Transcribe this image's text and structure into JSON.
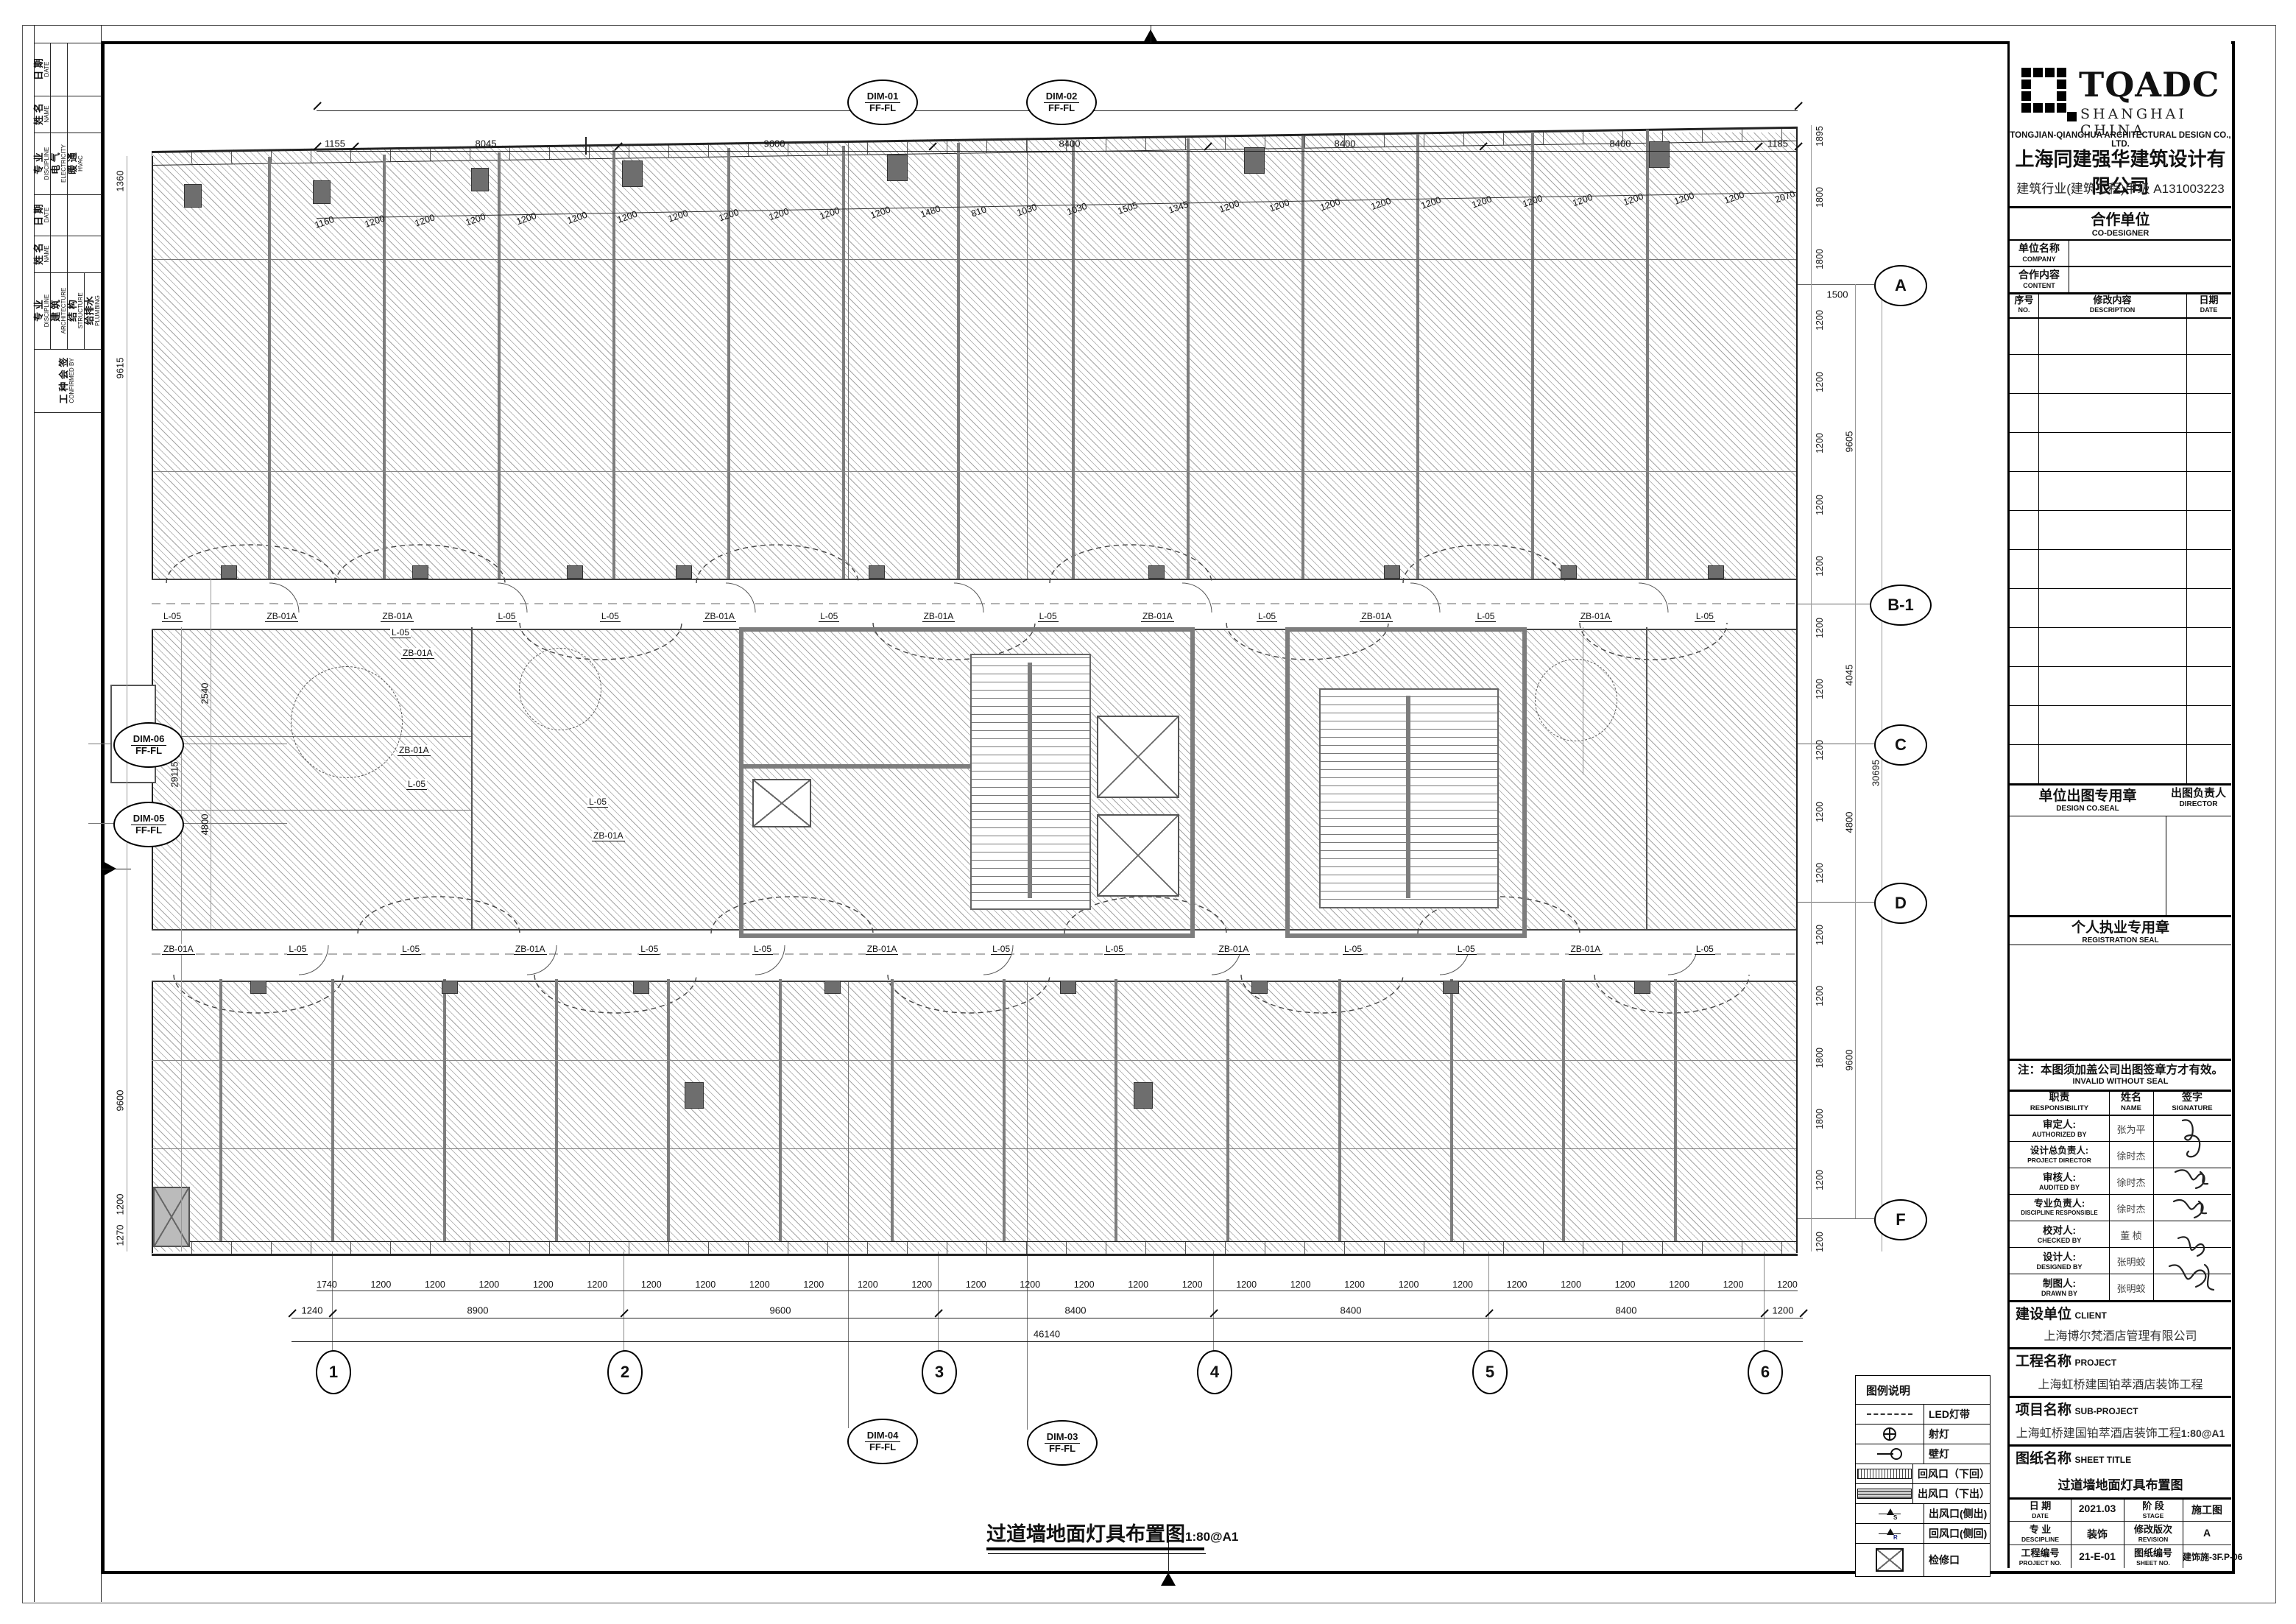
{
  "drawing": {
    "title": "过道墙地面灯具布置图",
    "scale": "1:80@A1"
  },
  "strip": {
    "date_cn": "日 期",
    "date_en": "DATE",
    "name_cn": "姓 名",
    "name_en": "NAME",
    "disc_cn": "专 业",
    "disc_en": "DISCIPLINE",
    "elec_cn": "电 气",
    "elec_en": "ELECTRICITY",
    "hvac_cn": "暖 通",
    "hvac_en": "HVAC",
    "arch_cn": "建 筑",
    "arch_en": "ARCHITECTURE",
    "struct_cn": "结 构",
    "struct_en": "STRUCTURE",
    "plumb_cn": "给排水",
    "plumb_en": "PLUMBING",
    "title_cn": "工 种 会 签",
    "title_en": "CONFIRMED BY"
  },
  "plan": {
    "grid_cols": [
      "1",
      "2",
      "3",
      "4",
      "5",
      "6"
    ],
    "grid_rows": [
      "A",
      "B-1",
      "C",
      "D",
      "F"
    ],
    "callouts": {
      "c1": {
        "id": "DIM-01",
        "tag": "FF-FL"
      },
      "c2": {
        "id": "DIM-02",
        "tag": "FF-FL"
      },
      "c3": {
        "id": "DIM-03",
        "tag": "FF-FL"
      },
      "c4": {
        "id": "DIM-04",
        "tag": "FF-FL"
      },
      "c5": {
        "id": "DIM-05",
        "tag": "FF-FL"
      },
      "c6": {
        "id": "DIM-06",
        "tag": "FF-FL"
      }
    },
    "dims": {
      "top_overall": "45200",
      "top_segments": [
        "1155",
        "8045",
        "9600",
        "8400",
        "8400",
        "8400",
        "1185"
      ],
      "top_detail": [
        "1160",
        "1200",
        "1200",
        "1200",
        "1200",
        "1200",
        "1200",
        "1200",
        "1200",
        "1200",
        "1200",
        "1200",
        "1480",
        "810",
        "1030",
        "1030",
        "1505",
        "1345",
        "1200",
        "1200",
        "1200",
        "1200",
        "1200",
        "1200",
        "1200",
        "1200",
        "1200",
        "1200",
        "1200",
        "2070"
      ],
      "bottom_detail": [
        "1740",
        "1200",
        "1200",
        "1200",
        "1200",
        "1200",
        "1200",
        "1200",
        "1200",
        "1200",
        "1200",
        "1200",
        "1200",
        "1200",
        "1200",
        "1200",
        "1200",
        "1200",
        "1200",
        "1200",
        "1200",
        "1200",
        "1200",
        "1200",
        "1200",
        "1200",
        "1200",
        "1200"
      ],
      "bottom_segments": [
        "1240",
        "8900",
        "9600",
        "8400",
        "8400",
        "8400",
        "1200"
      ],
      "bottom_overall": "46140",
      "left": [
        "1360",
        "9615",
        "2540",
        "29115",
        "4800",
        "9600",
        "1200",
        "1270"
      ],
      "right_ticks": [
        "1895",
        "1800",
        "1800",
        "1200",
        "1200",
        "1200",
        "1200",
        "1200",
        "1200",
        "1200",
        "1200",
        "1200",
        "1200",
        "1200",
        "1200",
        "1800",
        "1800",
        "1200",
        "1200"
      ],
      "right_segments": [
        "9605",
        "4045",
        "4800",
        "9600"
      ],
      "right_overall": "30695",
      "right_small": "1500"
    },
    "corridor_labels_upper": [
      "L-05",
      "ZB-01A",
      "ZB-01A",
      "L-05",
      "L-05",
      "ZB-01A",
      "L-05",
      "ZB-01A",
      "L-05",
      "ZB-01A",
      "L-05",
      "ZB-01A",
      "L-05",
      "ZB-01A",
      "L-05"
    ],
    "corridor_labels_lower": [
      "ZB-01A",
      "L-05",
      "L-05",
      "ZB-01A",
      "L-05",
      "L-05",
      "ZB-01A",
      "L-05",
      "L-05",
      "ZB-01A",
      "L-05",
      "L-05",
      "ZB-01A",
      "L-05"
    ],
    "mid_labels": [
      "L-05",
      "ZB-01A",
      "ZB-01A",
      "L-05",
      "L-05",
      "ZB-01A"
    ]
  },
  "legend": {
    "title": "图例说明",
    "rows": [
      {
        "symbol": "led-strip",
        "label": "LED灯带",
        "mark": ""
      },
      {
        "symbol": "spotlight",
        "label": "射灯",
        "mark": ""
      },
      {
        "symbol": "wall-lamp",
        "label": "壁灯",
        "mark": ""
      },
      {
        "symbol": "return-grille-down",
        "label": "回风口（下回）",
        "mark": ""
      },
      {
        "symbol": "supply-grille-down",
        "label": "出风口（下出）",
        "mark": ""
      },
      {
        "symbol": "supply-grille-side",
        "label": "出风口(侧出)",
        "mark": "S"
      },
      {
        "symbol": "return-grille-side",
        "label": "回风口(侧回)",
        "mark": "R"
      },
      {
        "symbol": "access-panel",
        "label": "检修口",
        "mark": ""
      }
    ]
  },
  "title_block": {
    "logo": {
      "acronym": "TQADC",
      "region": "SHANGHAI  CHINA",
      "company_en": "TONGJIAN-QIANGHUA ARCHITECTURAL DESIGN CO., LTD.",
      "company_cn": "上海同建强华建筑设计有限公司",
      "qualification": "建筑行业(建筑工程)甲级  A131003223"
    },
    "co_designer": {
      "header_cn": "合作单位",
      "header_en": "CO-DESIGNER",
      "company_cn": "单位名称",
      "company_en": "COMPANY",
      "content_cn": "合作内容",
      "content_en": "CONTENT"
    },
    "revision": {
      "no_cn": "序号",
      "no_en": "NO.",
      "desc_cn": "修改内容",
      "desc_en": "DESCRIPTION",
      "date_cn": "日期",
      "date_en": "DATE"
    },
    "seals": {
      "design_seal_cn": "单位出图专用章",
      "design_seal_en": "DESIGN CO.SEAL",
      "director_cn": "出图负责人",
      "director_en": "DIRECTOR",
      "registration_cn": "个人执业专用章",
      "registration_en": "REGISTRATION SEAL"
    },
    "note": {
      "cn": "注：本图须加盖公司出图签章方才有效。",
      "en": "INVALID WITHOUT SEAL"
    },
    "responsibility": {
      "role_cn": "职责",
      "role_en": "RESPONSIBILITY",
      "name_cn": "姓名",
      "name_en": "NAME",
      "sig_cn": "签字",
      "sig_en": "SIGNATURE",
      "rows": [
        {
          "role_cn": "审定人:",
          "role_en": "AUTHORIZED BY",
          "name": "张为平"
        },
        {
          "role_cn": "设计总负责人:",
          "role_en": "PROJECT DIRECTOR",
          "name": "徐时杰"
        },
        {
          "role_cn": "审核人:",
          "role_en": "AUDITED BY",
          "name": "徐时杰"
        },
        {
          "role_cn": "专业负责人:",
          "role_en": "DISCIPLINE RESPONSIBLE",
          "name": "徐时杰"
        },
        {
          "role_cn": "校对人:",
          "role_en": "CHECKED BY",
          "name": "董  桢"
        },
        {
          "role_cn": "设计人:",
          "role_en": "DESIGNED BY",
          "name": "张明蛟"
        },
        {
          "role_cn": "制图人:",
          "role_en": "DRAWN BY",
          "name": "张明蛟"
        }
      ]
    },
    "client": {
      "label_cn": "建设单位",
      "label_en": "CLIENT",
      "value": "上海博尔梵酒店管理有限公司"
    },
    "project": {
      "label_cn": "工程名称",
      "label_en": "PROJECT",
      "value": "上海虹桥建国铂萃酒店装饰工程"
    },
    "sub_project": {
      "label_cn": "项目名称",
      "label_en": "SUB-PROJECT",
      "value": "上海虹桥建国铂萃酒店装饰工程",
      "overlap": "1:80@A1"
    },
    "sheet_title": {
      "label_cn": "图纸名称",
      "label_en": "SHEET TITLE",
      "value": "过道墙地面灯具布置图"
    },
    "footer": {
      "date_cn": "日  期",
      "date_en": "DATE",
      "date_val": "2021.03",
      "stage_cn": "阶  段",
      "stage_en": "STAGE",
      "stage_val": "施工图",
      "disc_cn": "专  业",
      "disc_en": "DESCIPLINE",
      "disc_val": "装饰",
      "rev_cn": "修改版次",
      "rev_en": "REVISION",
      "rev_val": "A",
      "projno_cn": "工程编号",
      "projno_en": "PROJECT NO.",
      "projno_val": "21-E-01",
      "sheetno_cn": "图纸编号",
      "sheetno_en": "SHEET NO.",
      "sheetno_val": "建饰施-3F.P-06"
    }
  }
}
